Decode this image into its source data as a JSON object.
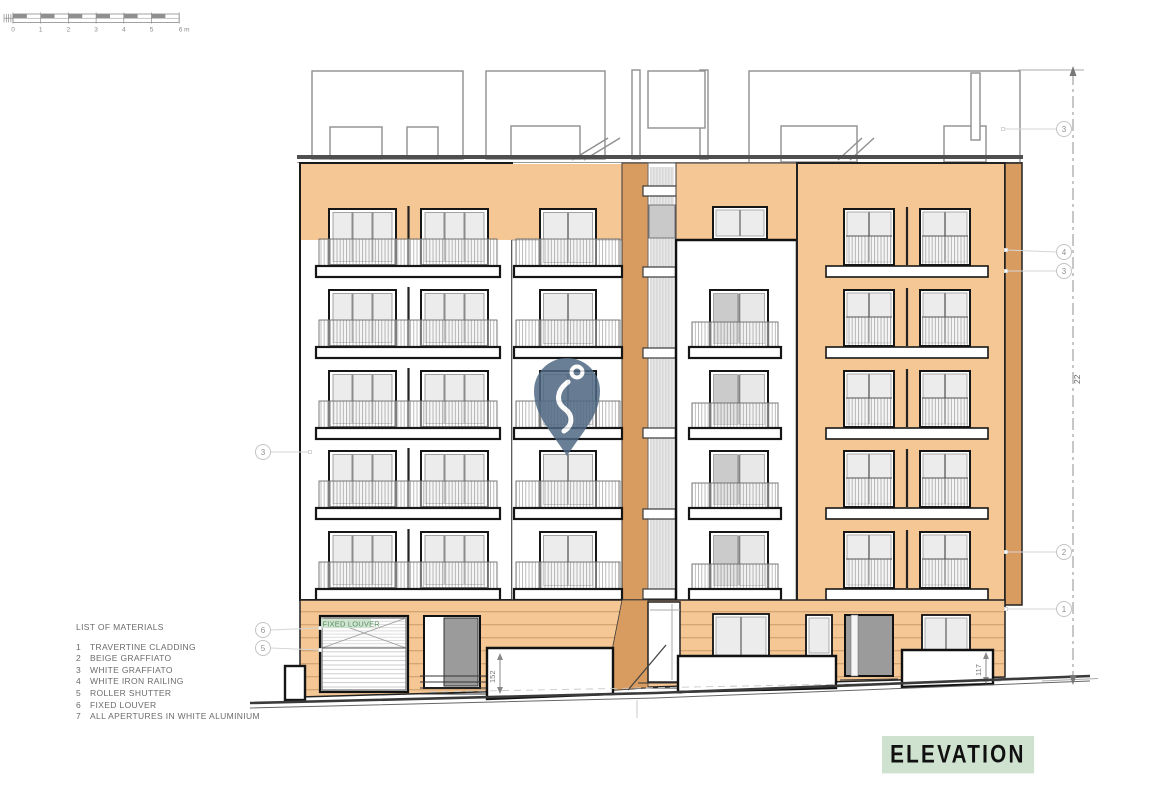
{
  "drawing": {
    "title": "ELEVATION",
    "watermark": "location-pin-logo"
  },
  "scale_bar": {
    "unit_labels": [
      "0",
      "1",
      "2",
      "3",
      "4",
      "5",
      "6 m"
    ]
  },
  "materials_list": {
    "title": "LIST OF MATERIALS",
    "items": [
      {
        "num": "1",
        "label": "TRAVERTINE CLADDING"
      },
      {
        "num": "2",
        "label": "BEIGE GRAFFIATO"
      },
      {
        "num": "3",
        "label": "WHITE GRAFFIATO"
      },
      {
        "num": "4",
        "label": "WHITE IRON RAILING"
      },
      {
        "num": "5",
        "label": "ROLLER SHUTTER"
      },
      {
        "num": "6",
        "label": "FIXED LOUVER"
      },
      {
        "num": "7",
        "label": "ALL APERTURES IN WHITE ALUMINIUM"
      }
    ]
  },
  "dimensions": {
    "building_height": "22",
    "left_parapet": "152",
    "right_parapet": "117"
  },
  "annotations": {
    "fixed_louver_label": "FIXED LOUVER",
    "callouts_left": [
      {
        "num": "3",
        "x": 263,
        "y": 452,
        "lx": 310,
        "ly": 452
      },
      {
        "num": "6",
        "x": 263,
        "y": 630,
        "lx": 320,
        "ly": 628
      },
      {
        "num": "5",
        "x": 263,
        "y": 648,
        "lx": 320,
        "ly": 650
      }
    ],
    "callouts_right": [
      {
        "num": "3",
        "x": 1064,
        "y": 129,
        "lx": 1003,
        "ly": 129
      },
      {
        "num": "4",
        "x": 1064,
        "y": 252,
        "lx": 1006,
        "ly": 250
      },
      {
        "num": "3",
        "x": 1064,
        "y": 271,
        "lx": 1006,
        "ly": 271
      },
      {
        "num": "2",
        "x": 1064,
        "y": 552,
        "lx": 1006,
        "ly": 552
      },
      {
        "num": "1",
        "x": 1064,
        "y": 609,
        "lx": 1006,
        "ly": 609
      }
    ]
  },
  "colors": {
    "beige_graffiato": "#f5c795",
    "travertine_cladding": "#f4c795",
    "dark_reveal": "#d99c60",
    "title_highlight_green": "#cfe2cf",
    "fixed_louver_green": "#55905f",
    "watermark_blue": "#506984"
  }
}
